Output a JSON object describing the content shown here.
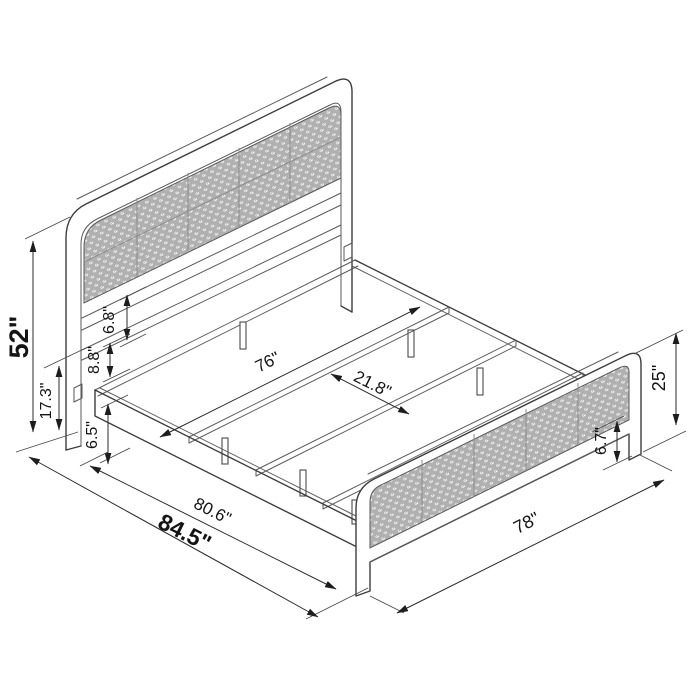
{
  "diagram": {
    "type": "isometric-furniture-dimension-drawing",
    "subject": "metal platform bed with cane rattan headboard and footboard",
    "colors": {
      "background": "#ffffff",
      "line": "#3d3d3d",
      "dimension_line": "#2b2b2b",
      "label_text": "#141414",
      "cane_panel_gray": "#b0b0b0",
      "cane_hole_white": "#ffffff",
      "panel_seam_gray": "#8d8d8d"
    }
  },
  "dimensions": {
    "headboard_height": "52\"",
    "headboard_frame_height": "17.3\"",
    "headboard_panel_gap": "6.8\"",
    "headboard_bar_spacing": "8.8\"",
    "side_rail_height": "6.5\"",
    "inner_width": "76\"",
    "slat_spacing": "21.8\"",
    "inner_length": "80.6\"",
    "overall_length": "84.5\"",
    "footboard_width": "78\"",
    "footboard_height": "25\"",
    "footboard_leg_height": "6.7\""
  }
}
